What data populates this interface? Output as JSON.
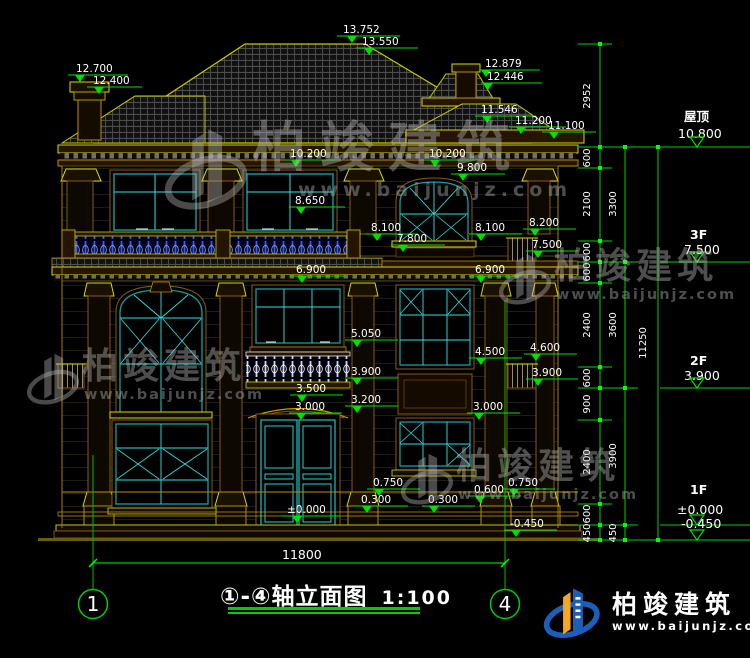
{
  "drawing": {
    "title_range": "①-④",
    "title_text": "轴立面图",
    "scale": "1:100",
    "axis_start": "1",
    "axis_end": "4"
  },
  "elevation_markers": [
    "12.700",
    "12.400",
    "13.752",
    "13.550",
    "12.879",
    "12.446",
    "11.546",
    "11.200",
    "11.100",
    "10.200",
    "10.200",
    "9.800",
    "8.650",
    "8.100",
    "7.800",
    "8.100",
    "8.200",
    "7.500",
    "6.900",
    "6.900",
    "5.050",
    "4.500",
    "4.600",
    "3.900",
    "3.900",
    "3.500",
    "3.200",
    "3.000",
    "3.000",
    "0.750",
    "0.300",
    "±0.000",
    "0.300",
    "0.600",
    "0.750",
    "-0.450"
  ],
  "floor_levels": [
    {
      "name": "屋顶",
      "elevation": "10.800"
    },
    {
      "name": "3F",
      "elevation": "7.500"
    },
    {
      "name": "2F",
      "elevation": "3.900"
    },
    {
      "name": "1F",
      "elevation": "±0.000"
    },
    {
      "name": "",
      "elevation": "-0.450"
    }
  ],
  "dimension_chains": {
    "inner": [
      "2952",
      "600",
      "2100",
      "600",
      "600",
      "2400",
      "600",
      "900",
      "2400",
      "600",
      "450"
    ],
    "middle": [
      "3300",
      "3600",
      "3900",
      "450"
    ],
    "outer": [
      "11250"
    ],
    "bottom": [
      "11800"
    ]
  },
  "watermark": {
    "brand": "柏竣建筑",
    "url": "www.baijunjz.com"
  },
  "logo": {
    "brand": "柏竣建筑",
    "url": "www.baijunjz.com"
  },
  "colors": {
    "dimension_green": "#00ff00",
    "outline_yellow": "#d8d800",
    "window_teal": "#0fa0a0",
    "baluster_blue": "#3b5bff",
    "logo_blue": "#1c5fb8",
    "logo_orange": "#f5a623"
  }
}
